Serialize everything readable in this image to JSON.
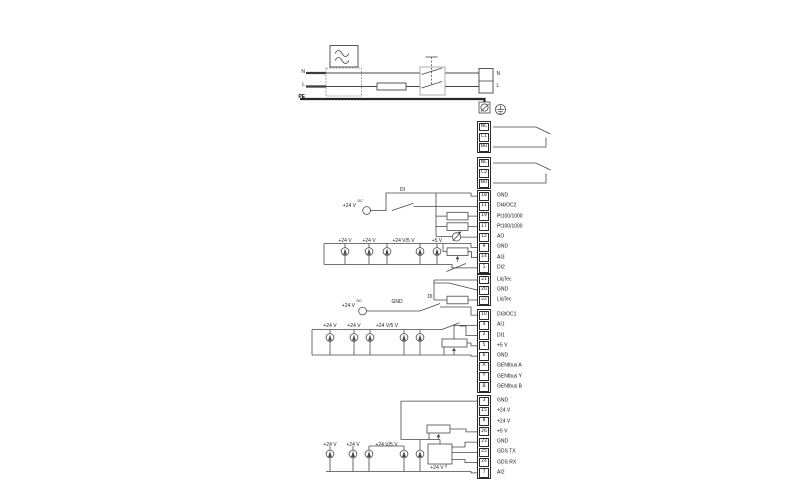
{
  "mains": {
    "n": "N",
    "l": "L",
    "pe": "PE",
    "out_n": "N",
    "out_l": "L"
  },
  "sections": {
    "di4": {
      "v24": "+24 V",
      "dc": "DC",
      "di": "DI"
    },
    "ai3": {
      "v24_a": "+24 V",
      "v24_b": "+24 V",
      "v24_5": "+24 V/5 V",
      "v5": "+5 V"
    },
    "di3": {
      "v24": "+24 V",
      "dc": "DC",
      "gnd": "GND",
      "di": "DI"
    },
    "ai1": {
      "v24_a": "+24 V",
      "v24_b": "+24 V",
      "v24_5": "+24 V/5 V"
    },
    "ai2": {
      "v24_a": "+24 V",
      "v24_b": "+24 V",
      "v24_5": "+24 V/5 V",
      "v24_gds": "+24 V"
    }
  },
  "terminal_groups": [
    {
      "name": "relay-1",
      "rows": [
        {
          "id": "NC",
          "label": ""
        },
        {
          "id": "C1",
          "label": ""
        },
        {
          "id": "NO",
          "label": ""
        }
      ]
    },
    {
      "name": "relay-2",
      "rows": [
        {
          "id": "NC",
          "label": ""
        },
        {
          "id": "C2",
          "label": ""
        },
        {
          "id": "NO",
          "label": ""
        }
      ]
    },
    {
      "name": "io-upper",
      "rows": [
        {
          "id": "18",
          "label": "GND"
        },
        {
          "id": "11",
          "label": "DI4/OC2"
        },
        {
          "id": "19",
          "label": "Pt100/1000"
        },
        {
          "id": "17",
          "label": "Pt100/1000"
        },
        {
          "id": "12",
          "label": "AO"
        },
        {
          "id": "9",
          "label": "GND"
        },
        {
          "id": "14",
          "label": "AI3"
        },
        {
          "id": "1",
          "label": "DI2"
        }
      ]
    },
    {
      "name": "liqtec",
      "rows": [
        {
          "id": "21",
          "label": "LiqTec"
        },
        {
          "id": "20",
          "label": "GND"
        },
        {
          "id": "22",
          "label": "LiqTec"
        }
      ]
    },
    {
      "name": "io-mid",
      "rows": [
        {
          "id": "10",
          "label": "DI3/OC1"
        },
        {
          "id": "4",
          "label": "AI1"
        },
        {
          "id": "2",
          "label": "DI1"
        },
        {
          "id": "5",
          "label": "+5 V"
        },
        {
          "id": "6",
          "label": "GND"
        },
        {
          "id": "A",
          "label": "GENIbus A"
        },
        {
          "id": "Y",
          "label": "GENIbus Y"
        },
        {
          "id": "B",
          "label": "GENIbus B"
        }
      ]
    },
    {
      "name": "io-lower",
      "rows": [
        {
          "id": "3",
          "label": "GND"
        },
        {
          "id": "15",
          "label": "+24 V"
        },
        {
          "id": "8",
          "label": "+24 V"
        },
        {
          "id": "26",
          "label": "+5 V"
        },
        {
          "id": "23",
          "label": "GND"
        },
        {
          "id": "25",
          "label": "GDS TX"
        },
        {
          "id": "24",
          "label": "GDS RX"
        },
        {
          "id": "7",
          "label": "AI2"
        }
      ]
    }
  ]
}
